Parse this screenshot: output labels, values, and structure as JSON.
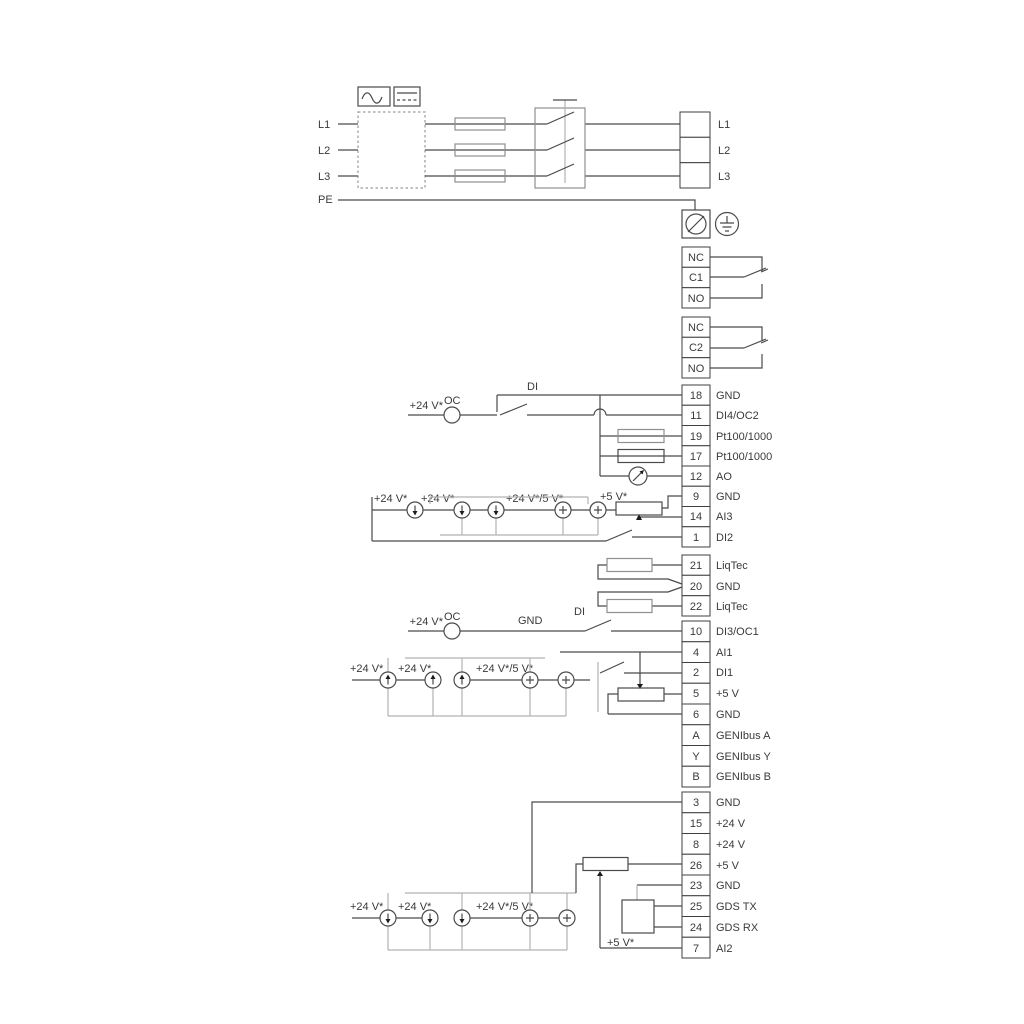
{
  "colors": {
    "background": "#ffffff",
    "wire_dark": "#4a4a4a",
    "wire_gray": "#b2b2b2",
    "text": "#3a3a3a"
  },
  "labels": {
    "plus24": "+24 V*",
    "plus24or5": "+24 V*/5 V*",
    "plus5": "+5 V*",
    "oc": "OC",
    "di": "DI",
    "gnd": "GND"
  },
  "power": {
    "inputs": [
      "L1",
      "L2",
      "L3",
      "PE"
    ],
    "outputs": [
      "L1",
      "L2",
      "L3"
    ]
  },
  "relay1": [
    "NC",
    "C1",
    "NO"
  ],
  "relay2": [
    "NC",
    "C2",
    "NO"
  ],
  "io1": [
    [
      "18",
      "GND"
    ],
    [
      "11",
      "DI4/OC2"
    ],
    [
      "19",
      "Pt100/1000"
    ],
    [
      "17",
      "Pt100/1000"
    ],
    [
      "12",
      "AO"
    ],
    [
      "9",
      "GND"
    ],
    [
      "14",
      "AI3"
    ],
    [
      "1",
      "DI2"
    ]
  ],
  "liqtec": [
    [
      "21",
      "LiqTec"
    ],
    [
      "20",
      "GND"
    ],
    [
      "22",
      "LiqTec"
    ]
  ],
  "io2": [
    [
      "10",
      "DI3/OC1"
    ],
    [
      "4",
      "AI1"
    ],
    [
      "2",
      "DI1"
    ],
    [
      "5",
      "+5 V"
    ],
    [
      "6",
      "GND"
    ],
    [
      "A",
      "GENIbus A"
    ],
    [
      "Y",
      "GENIbus Y"
    ],
    [
      "B",
      "GENIbus B"
    ]
  ],
  "io3": [
    [
      "3",
      "GND"
    ],
    [
      "15",
      "+24 V"
    ],
    [
      "8",
      "+24 V"
    ],
    [
      "26",
      "+5 V"
    ],
    [
      "23",
      "GND"
    ],
    [
      "25",
      "GDS TX"
    ],
    [
      "24",
      "GDS RX"
    ],
    [
      "7",
      "AI2"
    ]
  ]
}
